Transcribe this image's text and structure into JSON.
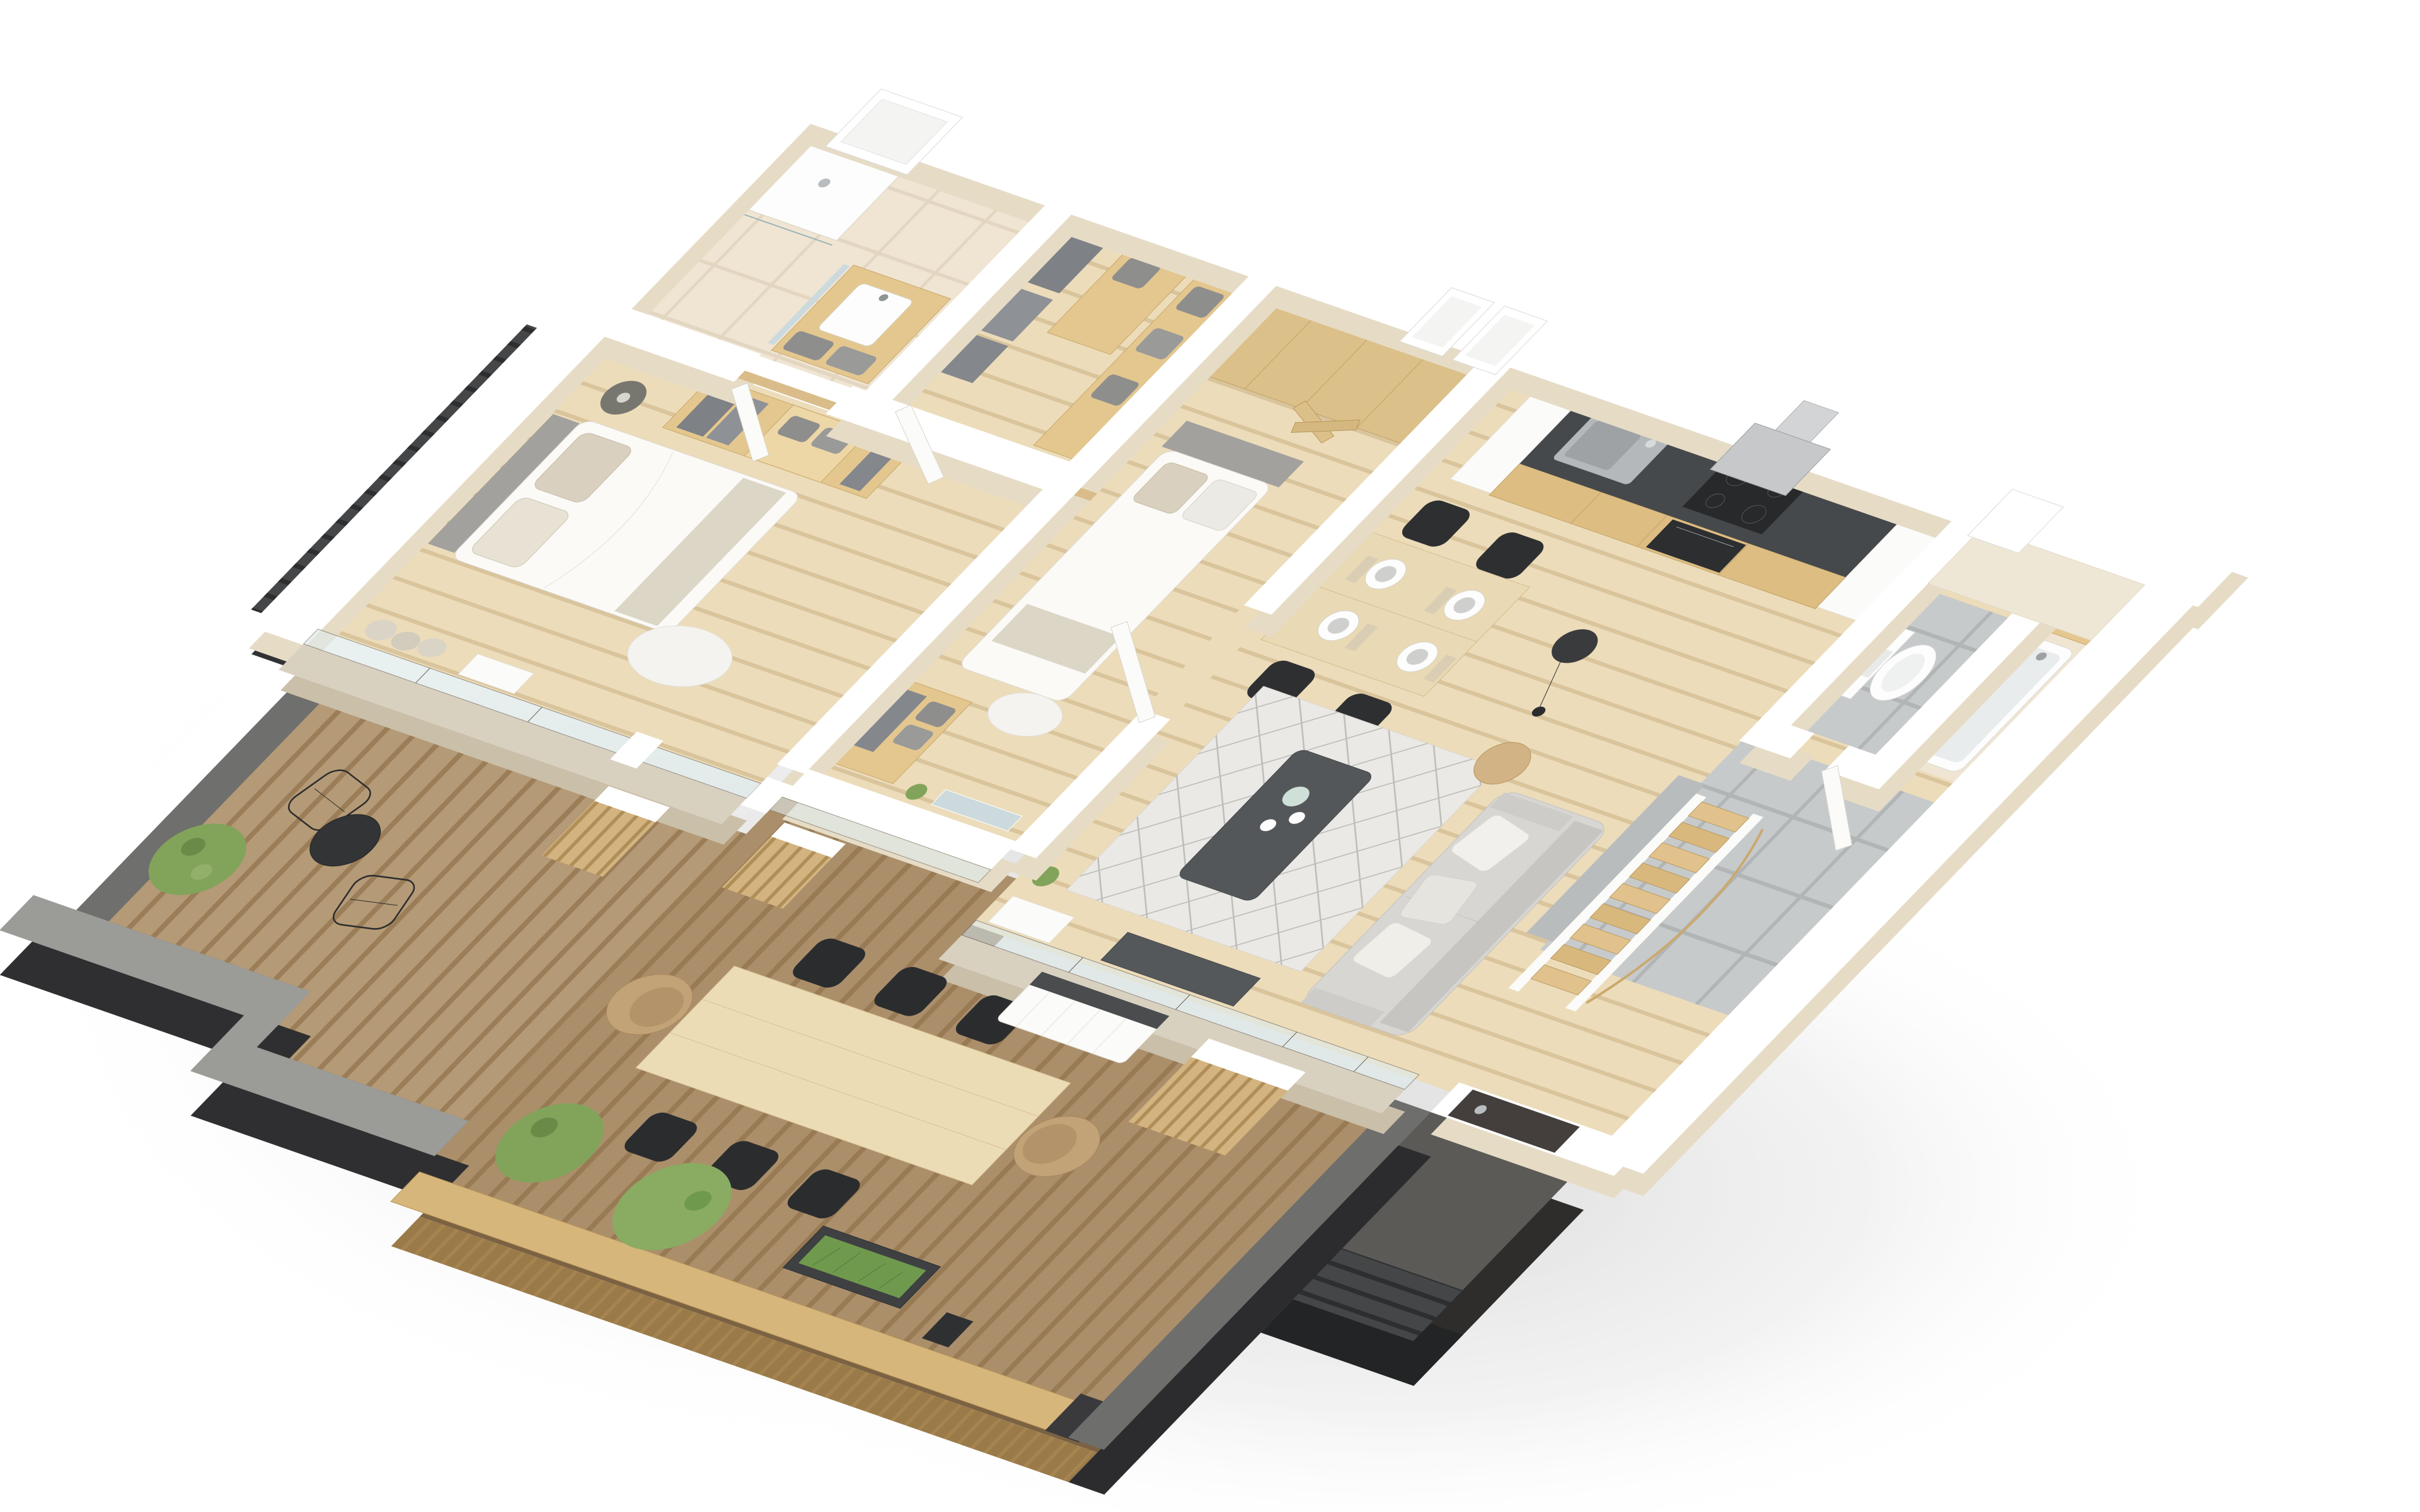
{
  "scene": {
    "kind": "3d-floor-plan-render",
    "view": "isometric-top-down",
    "background": "#ffffff",
    "visible_text": "none"
  },
  "palette": {
    "background": "#ffffff",
    "wall_top": "#ffffff",
    "wall_face_cream": "#e6dcc6",
    "interior_wood_floor": "#ecdcba",
    "plank_line": "#d9c49c",
    "terrace_deck": "#b49a76",
    "deck_gap_line": "#8d6f48",
    "deck_slab_face": "#7b6242",
    "gray_parapet_top": "#9b9b98",
    "gray_parapet_face": "#6f6f6d",
    "parapet_dark_face": "#2f2f31",
    "slate_wall": "#454648",
    "slate_line": "#2d2e30",
    "wood_fence_cap": "#d7b67c",
    "wood_fence_face": "#9a7a49",
    "kitchen_counter": "#46494b",
    "kitchen_cabinet_wood": "#ddbd82",
    "appliance_dark": "#2c2e30",
    "hood_steel": "#c6c8ca",
    "sink_steel": "#b4b8ba",
    "dining_table_wood": "#e9d9b4",
    "outdoor_table_wood": "#ecdcb6",
    "chair_black": "#2b2c2e",
    "wicker_chair": "#c2a377",
    "sofa_gray": "#d7d6d3",
    "rug_base": "#ebe9e5",
    "rug_pattern": "#bdbcb8",
    "coffee_table_dark": "#54575a",
    "bed_linen_white": "#fbfaf7",
    "headboard_gray": "#a3a19d",
    "pillow_beige": "#d9d0bf",
    "wardrobe_wood": "#e4c78f",
    "basket_gray": "#8e8e8c",
    "tile_gray": "#c7cacb",
    "tile_beige": "#f0e5d3",
    "glass": "#dfeaea",
    "glass_frame": "#6b6257",
    "plant_green": "#82a35a",
    "planter_dark": "#3e4042",
    "entry_door_dark": "#443f3c",
    "sanitary_white": "#fdfdfd"
  },
  "rooms": [
    {
      "name": "master-bedroom",
      "floor": "wood",
      "furniture": [
        "double-bed",
        "gray-headboard",
        "beige-pillows",
        "open-wardrobe",
        "hanging-clothes",
        "gray-baskets",
        "side-table",
        "sheepskin-rug",
        "curtains"
      ]
    },
    {
      "name": "ensuite-bathroom",
      "floor": "beige-tile",
      "furniture": [
        "walk-in-shower",
        "glass-screen",
        "vanity-counter",
        "square-basin",
        "mirror",
        "storage-baskets"
      ]
    },
    {
      "name": "walk-in-closet",
      "floor": "wood",
      "furniture": [
        "clothes-rail",
        "shelf-column",
        "gray-baskets",
        "white-door"
      ]
    },
    {
      "name": "second-bedroom",
      "floor": "wood",
      "furniture": [
        "single-bed",
        "gray-headboard",
        "wardrobe-cabinets",
        "folding-doors",
        "dresser-with-baskets",
        "leaning-mirror",
        "white-door"
      ]
    },
    {
      "name": "kitchen",
      "floor": "wood",
      "furniture": [
        "counter-run",
        "sink",
        "faucet",
        "induction-hob",
        "oven",
        "extractor-hood",
        "tall-white-cabinets"
      ]
    },
    {
      "name": "dining-area",
      "floor": "wood",
      "furniture": [
        "wood-dining-table",
        "four-black-chairs",
        "four-place-settings"
      ]
    },
    {
      "name": "living-room",
      "floor": "wood",
      "furniture": [
        "gray-sofa",
        "scatter-pillows",
        "diamond-rug",
        "dark-coffee-table",
        "tea-set",
        "stump-side-table",
        "arc-floor-lamp",
        "media-unit",
        "cactus"
      ]
    },
    {
      "name": "wc",
      "floor": "gray-tile",
      "furniture": [
        "wall-hung-toilet",
        "flush-plate"
      ]
    },
    {
      "name": "bathroom-2",
      "floor": "beige-tile",
      "furniture": [
        "bathtub",
        "chrome-faucet",
        "wood-ledge"
      ]
    },
    {
      "name": "entry-hall",
      "floor": "gray-tile",
      "furniture": [
        "staircase",
        "curved-wood-balustrade",
        "white-door",
        "dark-entry-door"
      ]
    },
    {
      "name": "terrace-bistro",
      "floor": "deck",
      "furniture": [
        "two-wire-chairs",
        "round-bistro-table",
        "potted-shrub",
        "gray-parapet",
        "slat-screens"
      ]
    },
    {
      "name": "terrace-dining",
      "floor": "deck",
      "furniture": [
        "long-outdoor-table",
        "six-black-chairs",
        "two-wicker-chairs",
        "two-potted-shrubs",
        "grass-planter",
        "white-slat-bench",
        "wood-slat-parapet",
        "dark-pillar"
      ]
    },
    {
      "name": "exterior",
      "furniture": [
        "slate-stone-cladding",
        "white-wall-caps",
        "roof-light-niches",
        "drop-shadow"
      ]
    }
  ]
}
